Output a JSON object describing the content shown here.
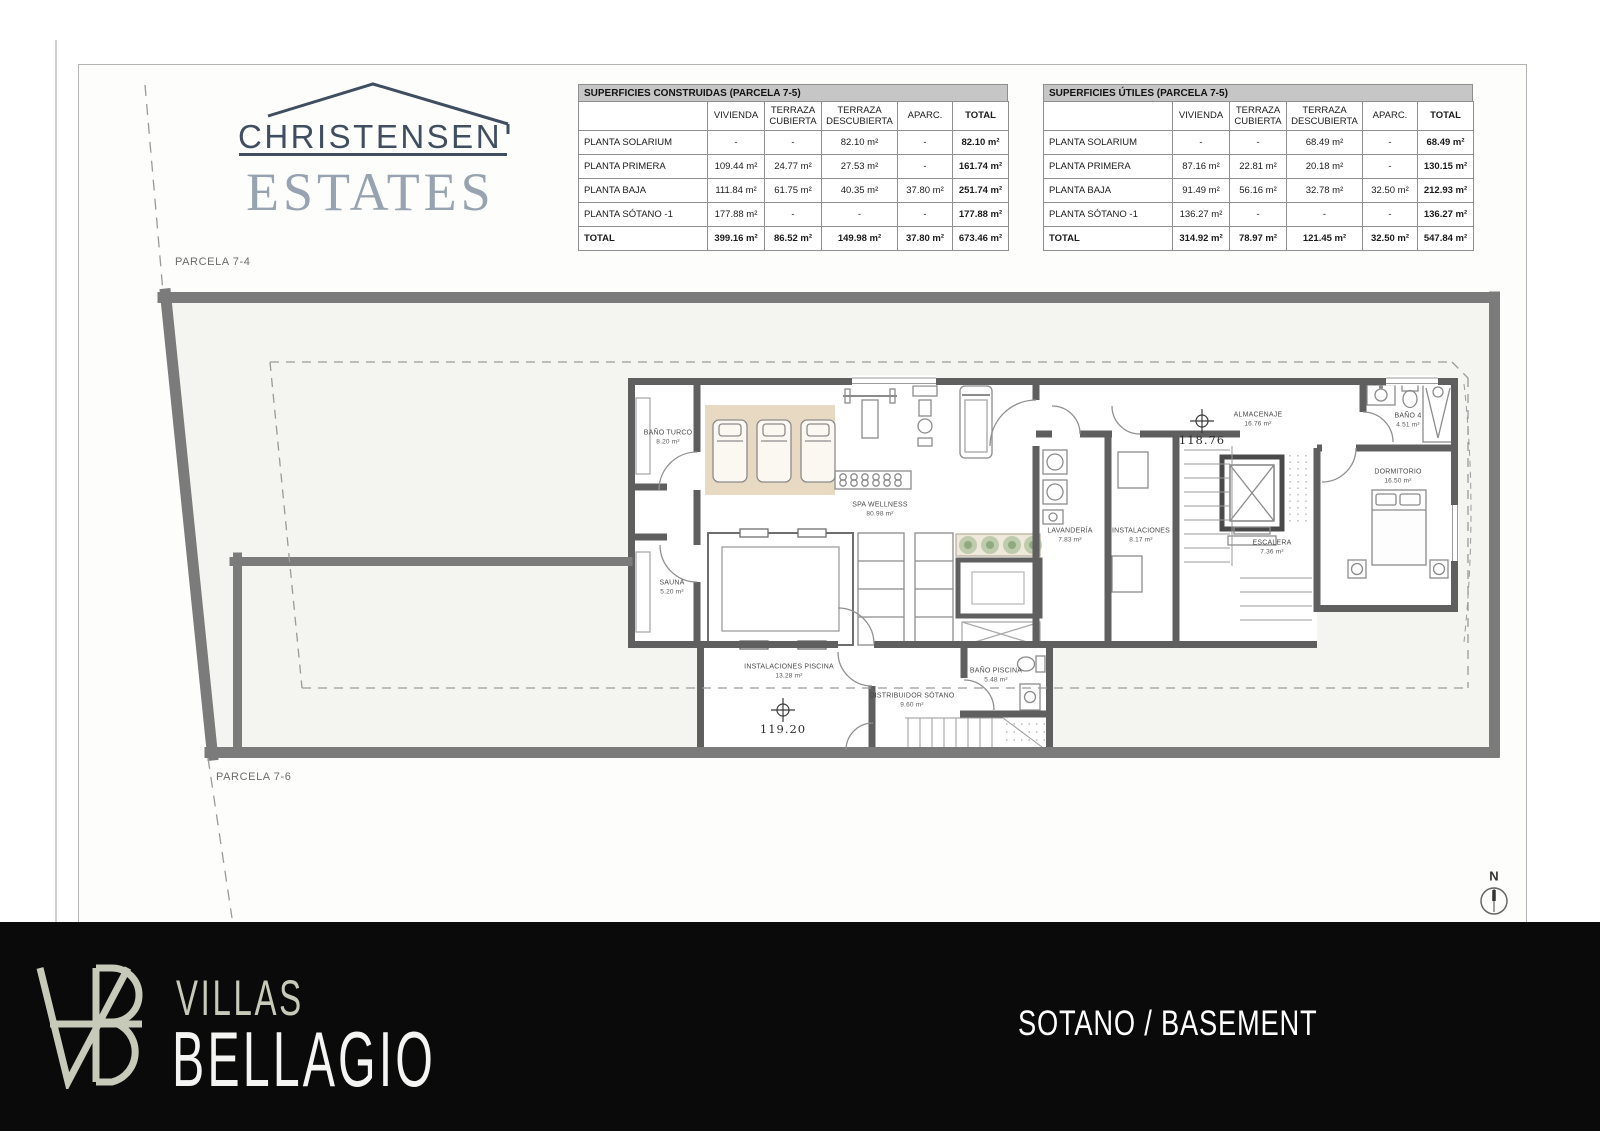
{
  "document": {
    "parcela_top": "PARCELA 7-4",
    "parcela_bottom": "PARCELA 7-6",
    "north_label": "N"
  },
  "logo": {
    "name": "CHRISTENSEN",
    "tagline": "ESTATES"
  },
  "tables": [
    {
      "title": "SUPERFICIES CONSTRUIDAS (PARCELA 7-5)",
      "columns": [
        "",
        "VIVIENDA",
        "TERRAZA CUBIERTA",
        "TERRAZA DESCUBIERTA",
        "APARC.",
        "TOTAL"
      ],
      "rows": [
        [
          "PLANTA SOLARIUM",
          "-",
          "-",
          "82.10 m²",
          "-",
          "82.10 m²"
        ],
        [
          "PLANTA PRIMERA",
          "109.44 m²",
          "24.77 m²",
          "27.53 m²",
          "-",
          "161.74 m²"
        ],
        [
          "PLANTA BAJA",
          "111.84 m²",
          "61.75 m²",
          "40.35 m²",
          "37.80 m²",
          "251.74 m²"
        ],
        [
          "PLANTA SÓTANO -1",
          "177.88 m²",
          "-",
          "-",
          "-",
          "177.88 m²"
        ],
        [
          "TOTAL",
          "399.16 m²",
          "86.52 m²",
          "149.98 m²",
          "37.80 m²",
          "673.46 m²"
        ]
      ]
    },
    {
      "title": "SUPERFICIES ÚTILES (PARCELA 7-5)",
      "columns": [
        "",
        "VIVIENDA",
        "TERRAZA CUBIERTA",
        "TERRAZA DESCUBIERTA",
        "APARC.",
        "TOTAL"
      ],
      "rows": [
        [
          "PLANTA SOLARIUM",
          "-",
          "-",
          "68.49 m²",
          "-",
          "68.49 m²"
        ],
        [
          "PLANTA PRIMERA",
          "87.16 m²",
          "22.81 m²",
          "20.18 m²",
          "-",
          "130.15 m²"
        ],
        [
          "PLANTA BAJA",
          "91.49 m²",
          "56.16 m²",
          "32.78 m²",
          "32.50 m²",
          "212.93 m²"
        ],
        [
          "PLANTA SÓTANO -1",
          "136.27 m²",
          "-",
          "-",
          "-",
          "136.27 m²"
        ],
        [
          "TOTAL",
          "314.92 m²",
          "78.97 m²",
          "121.45 m²",
          "32.50 m²",
          "547.84 m²"
        ]
      ]
    }
  ],
  "plan": {
    "rooms": [
      {
        "id": "bano-turco",
        "name": "BAÑO TURCO",
        "area": "8.20 m²"
      },
      {
        "id": "sauna",
        "name": "SAUNA",
        "area": "5.20 m²"
      },
      {
        "id": "spa",
        "name": "SPA WELLNESS",
        "area": "80.98 m²"
      },
      {
        "id": "almacenaje",
        "name": "ALMACENAJE",
        "area": "16.76 m²"
      },
      {
        "id": "lavanderia",
        "name": "LAVANDERÍA",
        "area": "7.83 m²"
      },
      {
        "id": "instalaciones",
        "name": "INSTALACIONES",
        "area": "8.17 m²"
      },
      {
        "id": "escalera",
        "name": "ESCALERA",
        "area": "7.36 m²"
      },
      {
        "id": "dormitorio",
        "name": "DORMITORIO",
        "area": "16.50 m²"
      },
      {
        "id": "bano4",
        "name": "BAÑO 4",
        "area": "4.51 m²"
      },
      {
        "id": "inst-piscina",
        "name": "INSTALACIONES PISCINA",
        "area": "13.28 m²"
      },
      {
        "id": "distribuidor",
        "name": "DISTRIBUIDOR SÓTANO",
        "area": "9.60 m²"
      },
      {
        "id": "bano-piscina",
        "name": "BAÑO PISCINA",
        "area": "5.48 m²"
      }
    ],
    "levels": [
      {
        "value": "118.76"
      },
      {
        "value": "119.20"
      }
    ]
  },
  "footer": {
    "monogram": "VB",
    "brand_top": "VILLAS",
    "brand_bottom": "BELLAGIO",
    "sheet_title": "SOTANO / BASEMENT"
  },
  "colors": {
    "banner": "#0a0a0a",
    "sage": "#c7cab9",
    "logo_navy": "#3f4e60",
    "logo_gray": "#97a3b1",
    "rug": "#e8d9c2",
    "boundary_wall": "#7b7b7b",
    "building_wall": "#5f5f5f"
  }
}
